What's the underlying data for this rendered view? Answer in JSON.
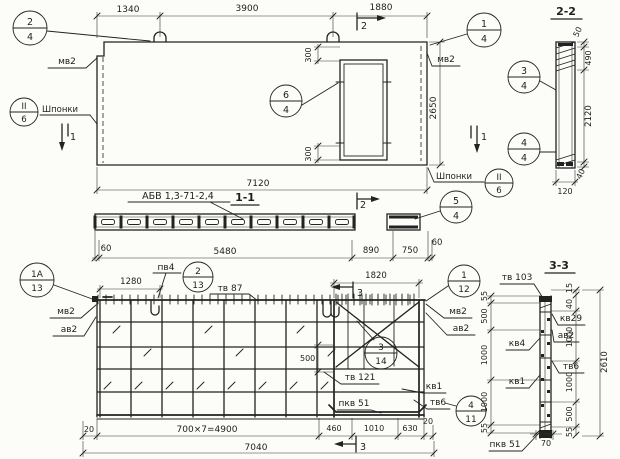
{
  "titles": {
    "s11": "1-1",
    "s22": "2-2",
    "s33": "3-3",
    "mark": "АБВ 1,3-71-2,4"
  },
  "cuts": {
    "c1": "1",
    "c2": "2",
    "c3": "3"
  },
  "labels": {
    "mv2": "мв2",
    "av2": "ав2",
    "shponki": "Шпонки",
    "pv4": "пв4",
    "tv87": "тв 87",
    "tv121": "тв 121",
    "kv1": "кв1",
    "pkv51": "пкв 51",
    "tv6": "тв6",
    "tv103": "тв 103",
    "kv29": "кв29",
    "kv4": "кв4"
  },
  "callouts": {
    "c24": {
      "top": "2",
      "bottom": "4"
    },
    "c14": {
      "top": "1",
      "bottom": "4"
    },
    "c34": {
      "top": "3",
      "bottom": "4"
    },
    "c44": {
      "top": "4",
      "bottom": "4"
    },
    "c54": {
      "top": "5",
      "bottom": "4"
    },
    "c64": {
      "top": "6",
      "bottom": "4"
    },
    "cII6": {
      "top": "II",
      "bottom": "6"
    },
    "c1a13": {
      "top": "1А",
      "bottom": "13"
    },
    "c213": {
      "top": "2",
      "bottom": "13"
    },
    "c314": {
      "top": "3",
      "bottom": "14"
    },
    "c112": {
      "top": "1",
      "bottom": "12"
    },
    "c411": {
      "top": "4",
      "bottom": "11"
    }
  },
  "dims": {
    "plan_top": [
      "1340",
      "3900",
      "1880"
    ],
    "plan_width": "7120",
    "plan_height": "2650",
    "opening": "300",
    "s22": [
      "50",
      "490",
      "2120",
      "40",
      "120"
    ],
    "s11": [
      "60",
      "5480",
      "890",
      "750",
      "60"
    ],
    "rebar_top": [
      "1280",
      "1820"
    ],
    "rebar_inner": "500",
    "rebar_bottom": [
      "20",
      "700×7=4900",
      "460",
      "1010",
      "630",
      "20"
    ],
    "rebar_total": "7040",
    "s33_left": [
      "55",
      "500",
      "1000",
      "1000",
      "55"
    ],
    "s33_right": [
      "15",
      "40",
      "1000",
      "1000",
      "500",
      "55"
    ],
    "s33_total": "2610",
    "s33_bottom": "70"
  }
}
